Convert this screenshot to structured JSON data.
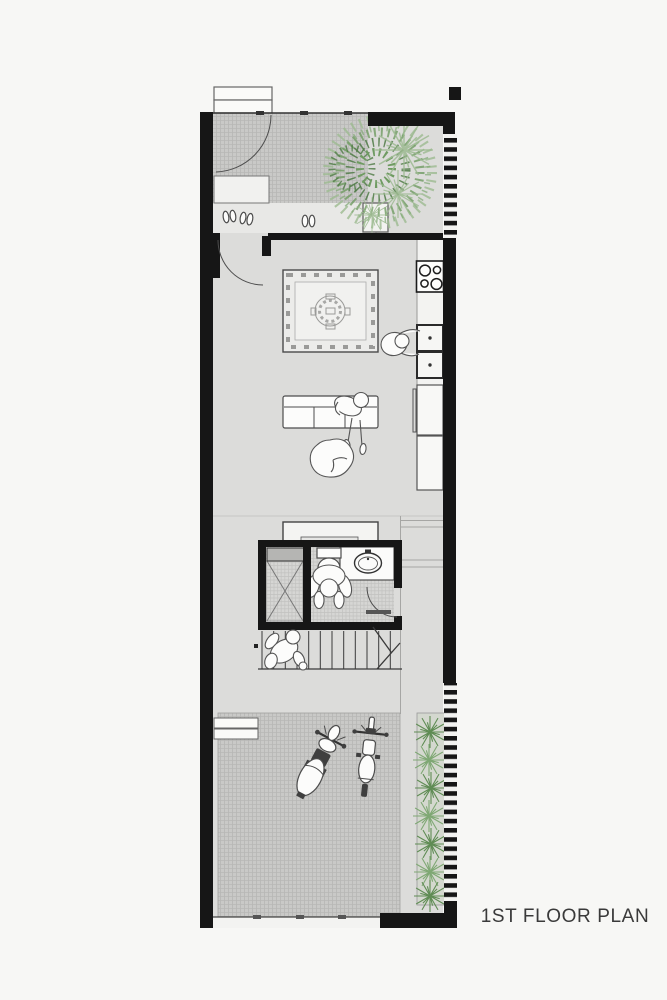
{
  "title": {
    "label": "1ST FLOOR PLAN"
  },
  "colors": {
    "background": "#f7f7f5",
    "wall": "#161616",
    "floor": "#dcdcda",
    "hatch": "#c9c9c7",
    "hatch_line": "#b7b7b5",
    "bath_floor": "#d6d6d4",
    "bath_line": "#c2c2c0",
    "tree_green": "#6f9b62",
    "tree_dark": "#4e7a44",
    "tree_light": "#9cba90",
    "plant_green": "#5f8c54",
    "plant_light": "#7fa874",
    "line": "#4a4a4a",
    "text": "#3a3a3a",
    "white": "#fcfcfb"
  },
  "fixtures": [
    "entry-steps",
    "entry-gate",
    "porch-floor",
    "entry-door-arc",
    "tree-icon",
    "shoe-area",
    "slippers-icon",
    "planter-box",
    "main-door-arc",
    "area-rug",
    "sofa",
    "person-standing-icon",
    "pouf",
    "stove-icon",
    "kitchen-sink-icon",
    "person-cooking-icon",
    "fridge",
    "cabinet",
    "console-table",
    "bathroom",
    "shower",
    "toilet-icon",
    "person-toilet-icon",
    "bathroom-sink-icon",
    "bathroom-door-arc",
    "stairs",
    "person-stairs-icon",
    "garage-court",
    "garage-steps",
    "scooter-icon",
    "motorbike-icon",
    "planter-strip",
    "shrub-icon",
    "fence-stripes",
    "bottom-gate"
  ],
  "counts": {
    "slipper_pairs": 3,
    "stove_burners": 4,
    "motorbikes": 2,
    "planter_shrubs": 7,
    "people": 4
  }
}
